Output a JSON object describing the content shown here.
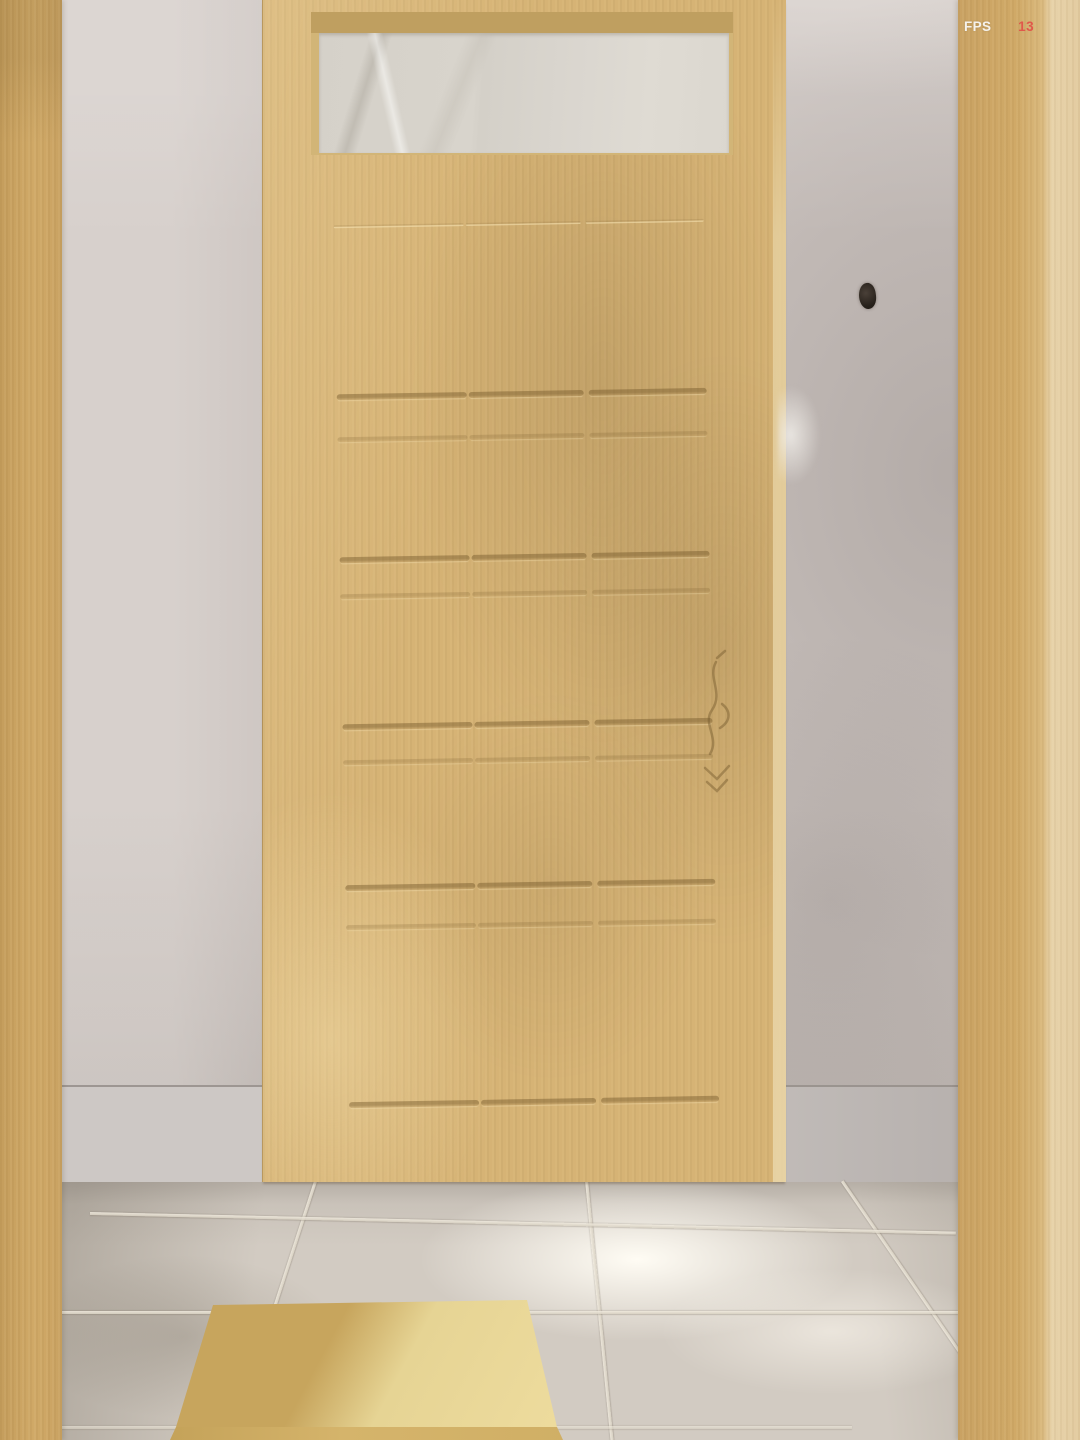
{
  "hud": {
    "fps_label": "FPS",
    "fps_value": "13"
  },
  "colors": {
    "fps_label_color": "#f5f2ec",
    "fps_value_color": "#e0584b",
    "door_wood": "#d6b375",
    "pillar_wood": "#d0a967",
    "pillar_wood_light": "#e7d2a9",
    "frame_bevel": "#bf9f60",
    "transom_glass": "#d8d4cc",
    "wall": "#c9c1bd",
    "baseboard": "#cdc8c5",
    "floor": "#d2cbc2",
    "floor_highlight": "#fffcf4",
    "grout": "#efe9dd",
    "box_top": "#e6d494",
    "box_top_shadow": "#c7a55d",
    "box_front": "#d5b46b",
    "dark_spot": "#251f19"
  }
}
